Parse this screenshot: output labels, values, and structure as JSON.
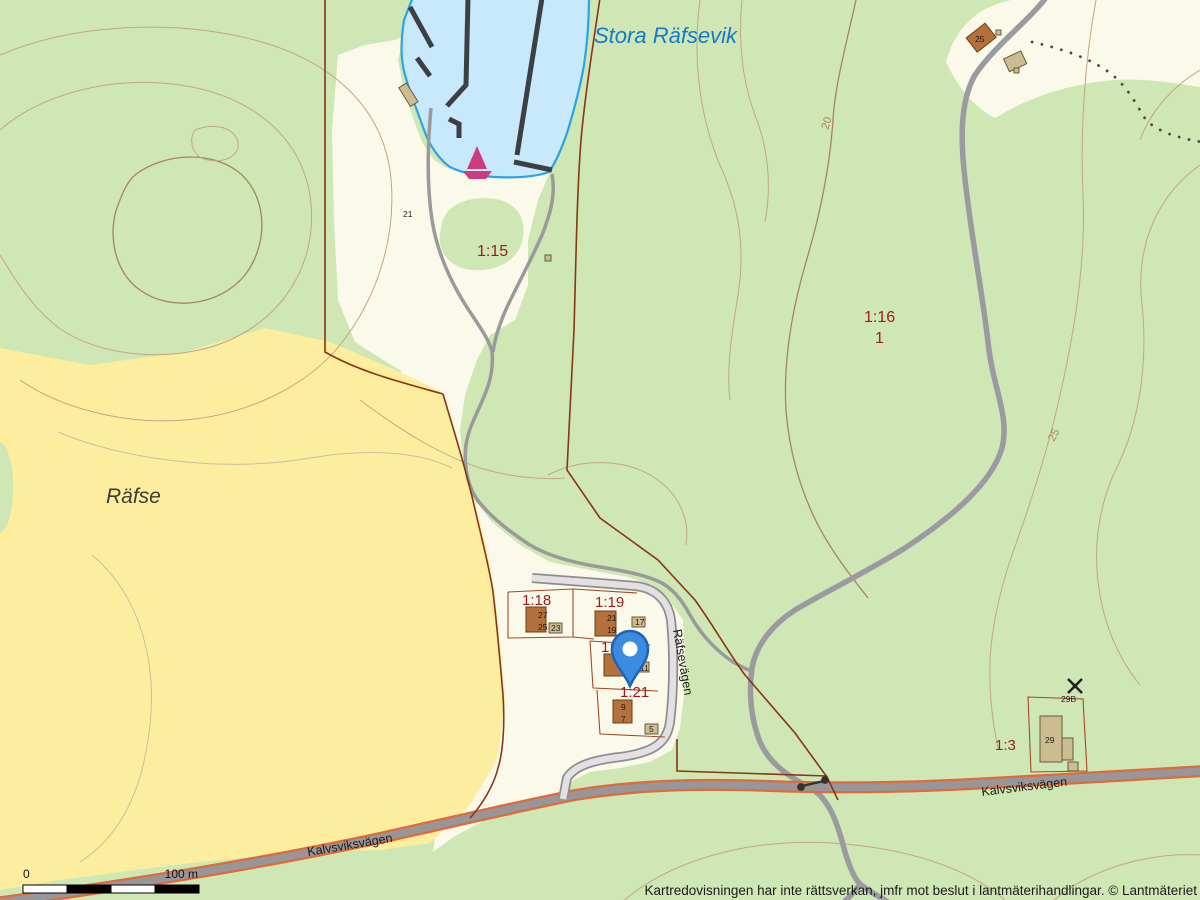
{
  "labels": {
    "water_name": "Stora Räfsevik",
    "area_name": "Räfse",
    "copyright": "Kartredovisningen har inte rättsverkan, jmfr mot beslut i lantmäterihandlingar. © Lantmäteriet"
  },
  "parcels": {
    "p15": "1:15",
    "p16": "1:16",
    "p16_sub": "1",
    "p18": "1:18",
    "p19": "1:19",
    "p20": "1:20",
    "p21": "1:21",
    "p3": "1:3"
  },
  "roads": {
    "kalvsviksvagen_west": "Kalvsviksvägen",
    "kalvsviksvagen_east": "Kalvsviksvägen",
    "rafsevagen": "Räfsevägen"
  },
  "contour_labels": {
    "c20": "20",
    "c25": "25"
  },
  "house_numbers": {
    "n27": "27",
    "n25": "25",
    "n23": "23",
    "n21": "21",
    "n19": "19",
    "n17": "17",
    "n11": "11",
    "n9": "9",
    "n7": "7",
    "n5": "5",
    "n25b": "25",
    "n29": "29",
    "n29b": "29B",
    "n21_shore": "21"
  },
  "scale_bar": {
    "zero": "0",
    "max": "100 m"
  },
  "colors": {
    "forest": "#cfe7b4",
    "open_land": "#fbf9e9",
    "field": "#fcee9e",
    "water_fill": "#c8e9fb",
    "water_line": "#2ba3e6",
    "road_major_edge": "#e06a38",
    "road_major_fill": "#97979b",
    "road_minor_fill": "#e2e0e2",
    "boundary": "#8a3418",
    "parcel_text": "#9b1c1c",
    "pin_fill": "#3b8ce0",
    "pin_stroke": "#1f64b4",
    "sailboat": "#cc3d7e"
  }
}
